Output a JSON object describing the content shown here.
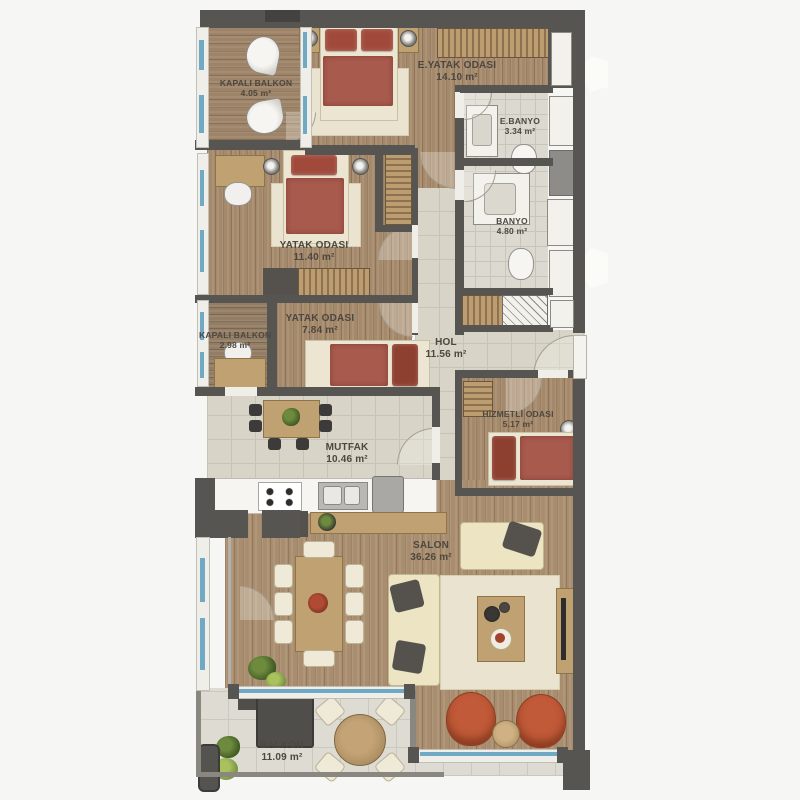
{
  "plan": {
    "type": "apartment-floor-plan",
    "rooms": {
      "kapali_balkon_ust": {
        "name": "KAPALI BALKON",
        "area": "4.05 m²"
      },
      "e_yatak_odasi": {
        "name": "E.YATAK ODASI",
        "area": "14.10 m²"
      },
      "e_banyo": {
        "name": "E.BANYO",
        "area": "3.34 m²"
      },
      "yatak_odasi_1140": {
        "name": "YATAK ODASI",
        "area": "11.40 m²"
      },
      "banyo": {
        "name": "BANYO",
        "area": "4.80 m²"
      },
      "kapali_balkon_alt": {
        "name": "KAPALI BALKON",
        "area": "2.98 m²"
      },
      "yatak_odasi_784": {
        "name": "YATAK ODASI",
        "area": "7.84 m²"
      },
      "hol": {
        "name": "HOL",
        "area": "11.56 m²"
      },
      "mutfak": {
        "name": "MUTFAK",
        "area": "10.46 m²"
      },
      "hizmetli_odasi": {
        "name": "HİZMETLİ ODASI",
        "area": "5.17 m²"
      },
      "salon": {
        "name": "SALON",
        "area": "36.26 m²"
      },
      "balkon": {
        "name": "BALKON",
        "area": "11.09 m²"
      }
    },
    "colors": {
      "wall": "#575552",
      "wood_floor": "#a5896b",
      "tile_floor": "#d8d4c8",
      "window_blue": "#6fa9c4",
      "bed_red": "#a85a4d",
      "armchair_orange": "#c05a38",
      "rug_cream": "#eae3cf"
    }
  }
}
